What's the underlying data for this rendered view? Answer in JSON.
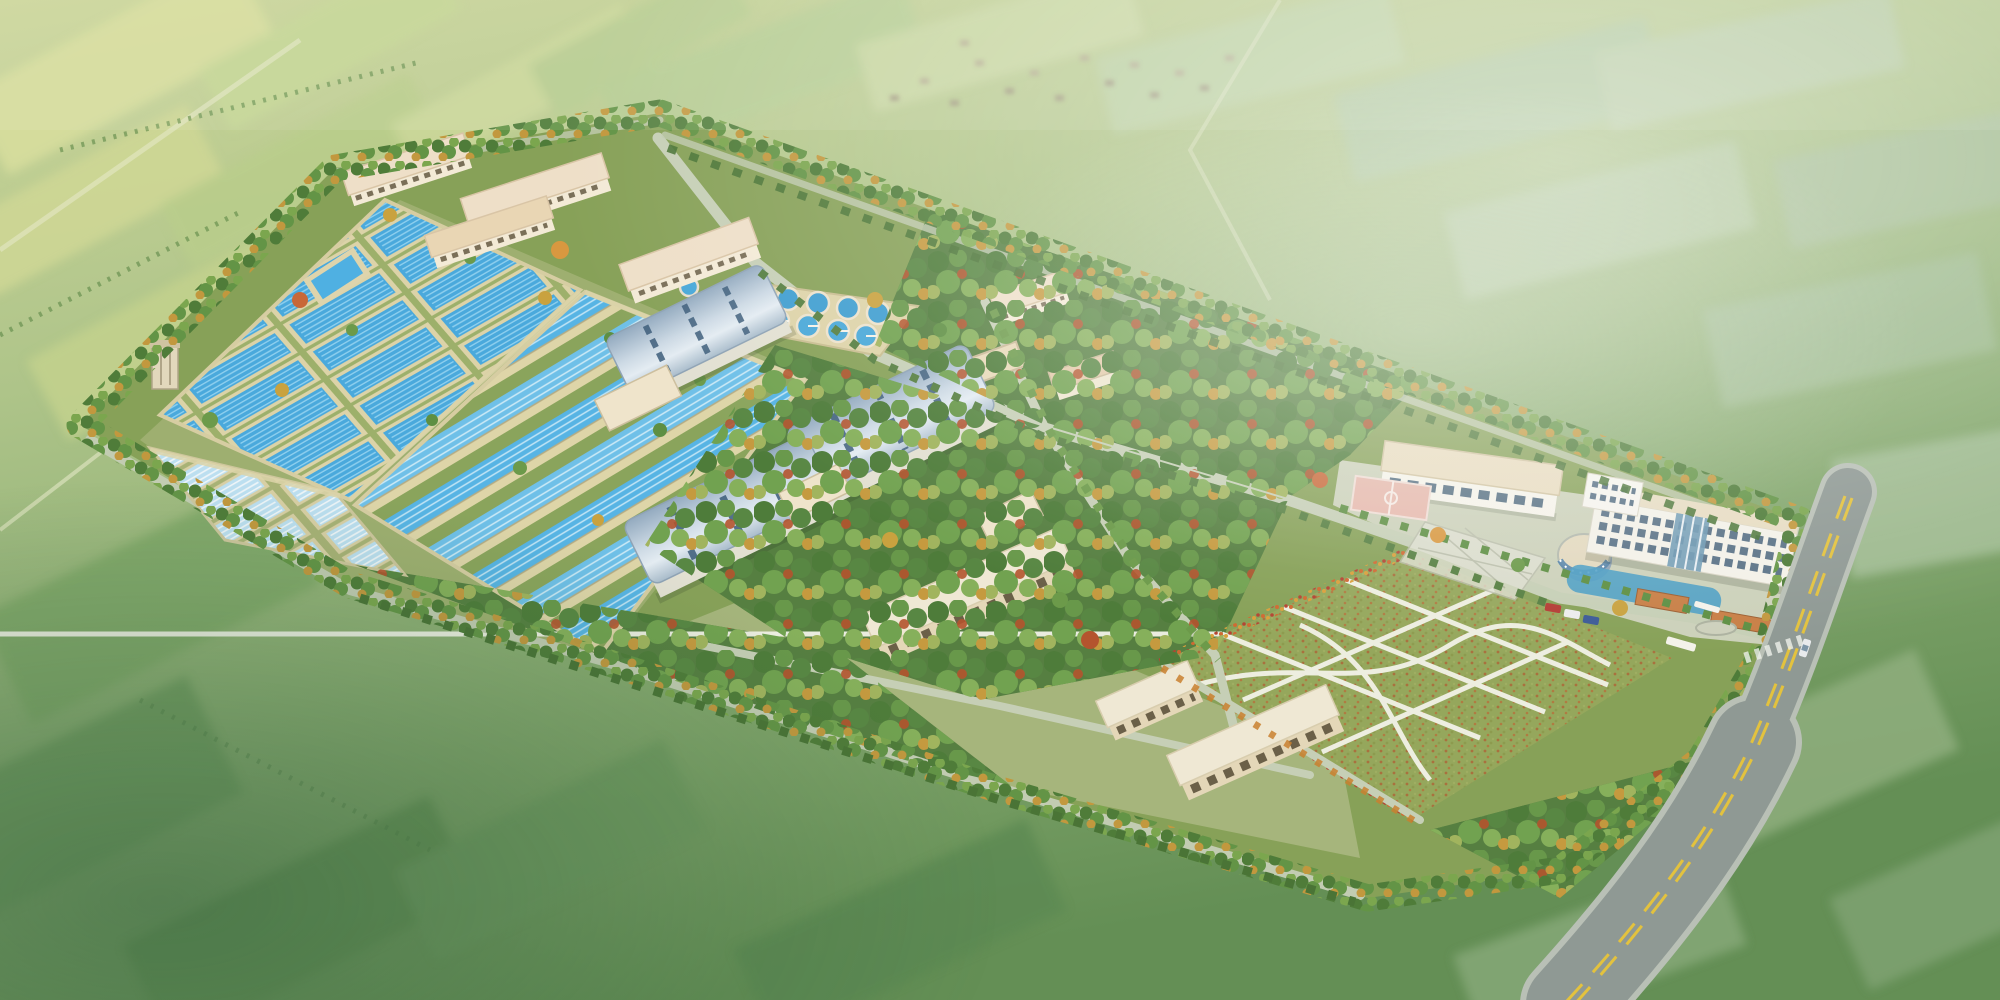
{
  "scene": {
    "type": "architectural aerial rendering",
    "subject": "water purification plant bird's-eye view over farmland"
  },
  "labels": {
    "title": "成都市自来水七厂一期工程 --- 净水厂鸟瞰图",
    "credit": "中国市政工程西南设计研究总院"
  },
  "palette": {
    "water": "#4fa9dc",
    "channel_water": "#57b4e4",
    "basin_frame": "#dcd3a8",
    "roof_blue": "#b7c9d8",
    "roof_beige": "#ecd9bd",
    "wall": "#f2e9d3",
    "tree_green": "#5e8f43",
    "tree_autumn": "#c79a3c",
    "lawn": "#95a75c",
    "road": "#c6cfb6",
    "highway": "#8f9994",
    "centerline_yellow": "#e3c23e",
    "field_light": "#cdd79b",
    "field_dark": "#6d9659"
  }
}
